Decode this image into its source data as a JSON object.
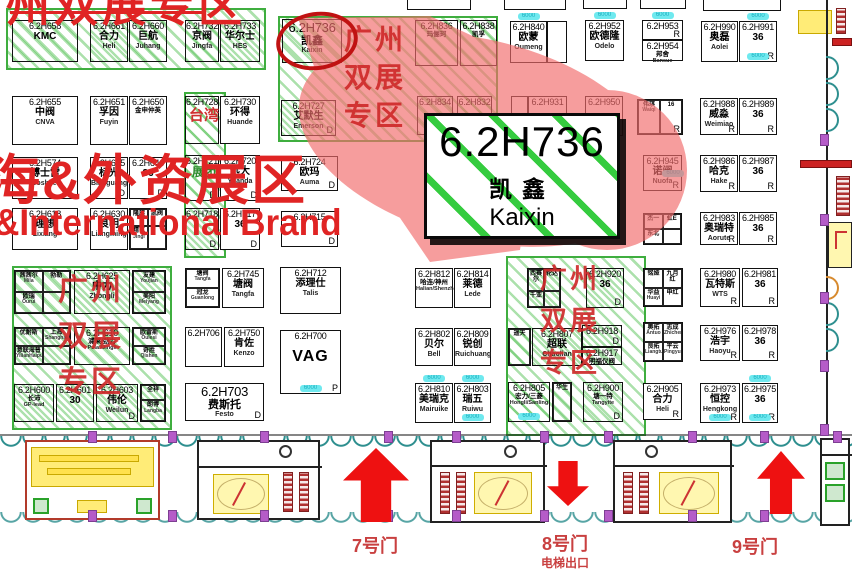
{
  "overlay": {
    "top_zone": "州双展专区",
    "brand_line1": "海&外资展区",
    "brand_line2": "&International Brand"
  },
  "highlight": {
    "code": "6.2H736",
    "cn": "凯鑫",
    "en": "Kaixin"
  },
  "badge_text": "6000",
  "colors": {
    "zone_green": "#3fae3f",
    "overlay_red": "#e02424",
    "blob_pink": "#f26c6c",
    "ellipse_red": "#c01212",
    "badge_cyan": "#6fe9ef",
    "arrow_red": "#ee1111",
    "gate_red": "#c94040",
    "column_purple": "#b55cc8",
    "wall_teal": "#2e8f8f"
  },
  "zones": [
    {
      "name": "zone-hatch-top-left",
      "x": 6,
      "y": 8,
      "w": 256,
      "h": 58
    },
    {
      "name": "zone-taiwan-strip",
      "x": 184,
      "y": 92,
      "w": 38,
      "h": 162
    },
    {
      "name": "zone-guangzhou-top-mid",
      "x": 278,
      "y": 16,
      "w": 216,
      "h": 122,
      "label": [
        "广州",
        "双展",
        "专区"
      ],
      "lx": 344,
      "ly": 26,
      "fs": 28,
      "gap": 10
    },
    {
      "name": "zone-guangzhou-left",
      "x": 12,
      "y": 266,
      "w": 156,
      "h": 160,
      "label": [
        "广州",
        "双展",
        "专区"
      ],
      "lx": 58,
      "ly": 276,
      "fs": 30,
      "gap": 16
    },
    {
      "name": "zone-guangzhou-right",
      "x": 506,
      "y": 256,
      "w": 136,
      "h": 176,
      "label": [
        "广州",
        "双展",
        "专区"
      ],
      "lx": 540,
      "ly": 266,
      "fs": 27,
      "gap": 15
    }
  ],
  "labels": [
    {
      "text": "台湾",
      "x": 189,
      "y": 108,
      "fs": 15,
      "color": "#d03030"
    },
    {
      "text": "展团",
      "x": 192,
      "y": 166,
      "fs": 12,
      "color": "#2a8a2a"
    }
  ],
  "slivers": [
    {
      "x": 407,
      "y": 0,
      "w": 62,
      "h": 9
    },
    {
      "x": 504,
      "y": 0,
      "w": 60,
      "h": 9
    },
    {
      "x": 583,
      "y": 0,
      "w": 42,
      "h": 8
    },
    {
      "x": 640,
      "y": 0,
      "w": 44,
      "h": 8
    },
    {
      "x": 703,
      "y": 0,
      "w": 76,
      "h": 10
    }
  ],
  "booths": [
    {
      "code": "6.2H658",
      "cn": "KMC",
      "x": 12,
      "y": 20,
      "w": 66,
      "h": 42,
      "hatch": 1
    },
    {
      "code": "6.2H661",
      "cn": "合力",
      "en": "Heli",
      "x": 90,
      "y": 20,
      "w": 38,
      "h": 42,
      "hatch": 1
    },
    {
      "code": "6.2H660",
      "cn": "巨航",
      "en": "Juhang",
      "x": 129,
      "y": 20,
      "w": 38,
      "h": 42,
      "hatch": 1
    },
    {
      "code": "6.2H732",
      "cn": "京阀",
      "en": "Jingfa",
      "x": 185,
      "y": 20,
      "w": 34,
      "h": 42,
      "hatch": 1
    },
    {
      "code": "6.2H733",
      "cn": "华尔士",
      "en": "HES",
      "x": 220,
      "y": 20,
      "w": 40,
      "h": 42,
      "hatch": 1
    },
    {
      "code": "6.2H736",
      "cn": "凯鑫",
      "en": "Kaixin",
      "x": 282,
      "y": 19,
      "w": 60,
      "h": 44,
      "hatch": 1,
      "big": 1
    },
    {
      "code": "6.2H836",
      "cn": "玛俪珂",
      "x": 415,
      "y": 20,
      "w": 43,
      "h": 46,
      "hatch": 1,
      "tiny": 1
    },
    {
      "code": "6.2H838",
      "cn": "凯孚",
      "x": 460,
      "y": 20,
      "w": 37,
      "h": 46,
      "hatch": 1,
      "tiny": 1
    },
    {
      "code": "6.2H840",
      "cn": "欧蒙",
      "en": "Oumeng",
      "x": 510,
      "y": 21,
      "w": 37,
      "h": 42,
      "badges": [
        "t"
      ]
    },
    {
      "code": "",
      "x": 547,
      "y": 21,
      "w": 20,
      "h": 42
    },
    {
      "code": "6.2H952",
      "cn": "欧德隆",
      "en": "Odelo",
      "x": 585,
      "y": 20,
      "w": 39,
      "h": 41,
      "badges": [
        "t"
      ]
    },
    {
      "code": "6.2H953",
      "marker": "R",
      "x": 642,
      "y": 20,
      "w": 41,
      "h": 20,
      "badges": [
        "t"
      ]
    },
    {
      "code": "6.2H954",
      "cn": "邦舍",
      "en": "Bansue",
      "x": 642,
      "y": 40,
      "w": 41,
      "h": 21,
      "tiny": 1
    },
    {
      "code": "6.2H990",
      "cn": "奥磊",
      "en": "Aolei",
      "x": 701,
      "y": 21,
      "w": 37,
      "h": 41
    },
    {
      "code": "6.2H991",
      "cn": "36",
      "marker": "R",
      "x": 739,
      "y": 21,
      "w": 38,
      "h": 41,
      "badges": [
        "t",
        "b"
      ]
    },
    {
      "code": "6.2H655",
      "cn": "中阀",
      "en": "CNVA",
      "x": 12,
      "y": 96,
      "w": 66,
      "h": 49
    },
    {
      "code": "6.2H651",
      "cn": "孚因",
      "en": "Fuyin",
      "x": 90,
      "y": 96,
      "w": 38,
      "h": 49
    },
    {
      "code": "6.2H650",
      "cn": "金申仲英",
      "x": 129,
      "y": 96,
      "w": 38,
      "h": 49,
      "tiny": 1
    },
    {
      "code": "6.2H728",
      "x": 185,
      "y": 96,
      "w": 34,
      "h": 48,
      "hatch": 1
    },
    {
      "code": "6.2H730",
      "cn": "环得",
      "en": "Huande",
      "x": 220,
      "y": 96,
      "w": 40,
      "h": 48
    },
    {
      "code": "6.2H727",
      "cn": "艾默生",
      "en": "Emerson",
      "x": 281,
      "y": 100,
      "w": 55,
      "h": 36,
      "hatch": 1,
      "marker": "D"
    },
    {
      "code": "6.2H834",
      "x": 417,
      "y": 96,
      "w": 36,
      "h": 39,
      "hatch": 1
    },
    {
      "code": "6.2H832",
      "x": 457,
      "y": 96,
      "w": 35,
      "h": 39,
      "hatch": 1
    },
    {
      "code": "",
      "x": 511,
      "y": 96,
      "w": 17,
      "h": 40
    },
    {
      "code": "6.2H931",
      "x": 528,
      "y": 96,
      "w": 39,
      "h": 40
    },
    {
      "code": "6.2H950",
      "x": 585,
      "y": 96,
      "w": 38,
      "h": 40
    },
    {
      "cells": [
        {
          "t": "伟琪",
          "e": "Waiqi"
        },
        {
          "t": "16"
        }
      ],
      "x": 637,
      "y": 99,
      "w": 46,
      "h": 36,
      "marker": "R"
    },
    {
      "code": "6.2H988",
      "cn": "威淼",
      "en": "Weimiao",
      "marker": "R",
      "x": 700,
      "y": 98,
      "w": 38,
      "h": 37
    },
    {
      "code": "6.2H989",
      "cn": "36",
      "marker": "R",
      "x": 739,
      "y": 98,
      "w": 38,
      "h": 37
    },
    {
      "code": "6.2H574",
      "cn": "博士雷",
      "en": "Boshilei",
      "x": 12,
      "y": 157,
      "w": 66,
      "h": 42
    },
    {
      "code": "6.2H645",
      "cn": "标光",
      "en": "Biaoguang",
      "marker": "D",
      "x": 90,
      "y": 157,
      "w": 38,
      "h": 42
    },
    {
      "code": "6.2H646",
      "cn": "36",
      "marker": "D",
      "x": 129,
      "y": 157,
      "w": 38,
      "h": 42
    },
    {
      "code": "6.2H721",
      "marker": "D",
      "x": 185,
      "y": 155,
      "w": 34,
      "h": 46,
      "hatch": 1
    },
    {
      "code": "6.2H720",
      "cn": "远大",
      "en": "Yuanda",
      "marker": "D",
      "x": 220,
      "y": 155,
      "w": 40,
      "h": 46
    },
    {
      "code": "6.2H724",
      "cn": "欧玛",
      "en": "Auma",
      "marker": "D",
      "x": 281,
      "y": 156,
      "w": 57,
      "h": 35
    },
    {
      "code": "6.2H945",
      "cn": "诺阀",
      "en": "Nuofa",
      "marker": "R",
      "x": 643,
      "y": 155,
      "w": 39,
      "h": 36,
      "badges": [
        "r"
      ]
    },
    {
      "code": "6.2H986",
      "cn": "哈克",
      "en": "Hake",
      "marker": "R",
      "x": 700,
      "y": 155,
      "w": 38,
      "h": 37
    },
    {
      "code": "6.2H987",
      "cn": "36",
      "marker": "R",
      "x": 739,
      "y": 155,
      "w": 38,
      "h": 37
    },
    {
      "code": "6.2H618",
      "cn": "理想",
      "en": "Lixiang",
      "x": 12,
      "y": 208,
      "w": 66,
      "h": 42
    },
    {
      "code": "6.2H630",
      "cn": "良明",
      "en": "Liangming",
      "x": 90,
      "y": 208,
      "w": 38,
      "h": 42
    },
    {
      "cells": [
        {
          "t": "隆旗"
        },
        {
          "t": "凯阀"
        },
        {
          "t": "精艺",
          "e": "Jingi"
        },
        {
          "t": ""
        }
      ],
      "x": 129,
      "y": 208,
      "w": 38,
      "h": 42
    },
    {
      "code": "6.2H718",
      "marker": "D",
      "x": 185,
      "y": 208,
      "w": 34,
      "h": 42,
      "hatch": 1
    },
    {
      "code": "6.2H717",
      "cn": "36",
      "marker": "D",
      "x": 220,
      "y": 208,
      "w": 40,
      "h": 42
    },
    {
      "code": "6.2H715",
      "marker": "D",
      "x": 281,
      "y": 211,
      "w": 57,
      "h": 36
    },
    {
      "cells": [
        {
          "t": "杰一"
        },
        {
          "t": "虹E"
        },
        {
          "t": "东北"
        },
        {
          "t": ""
        }
      ],
      "x": 643,
      "y": 213,
      "w": 39,
      "h": 32
    },
    {
      "code": "6.2H983",
      "cn": "奥瑞特",
      "en": "Aorute",
      "marker": "R",
      "x": 700,
      "y": 212,
      "w": 38,
      "h": 33
    },
    {
      "code": "6.2H985",
      "cn": "36",
      "marker": "R",
      "x": 739,
      "y": 212,
      "w": 38,
      "h": 33
    },
    {
      "cells": [
        {
          "t": "茜茜尔",
          "e": "Mila"
        },
        {
          "t": "勃勒"
        },
        {
          "t": "欧瑞",
          "e": "Ourui"
        },
        {
          "t": ""
        }
      ],
      "x": 14,
      "y": 270,
      "w": 57,
      "h": 44,
      "hatch": 1
    },
    {
      "code": "6.2H625",
      "cn": "中力",
      "en": "Zhongli",
      "x": 74,
      "y": 270,
      "w": 56,
      "h": 44,
      "hatch": 1
    },
    {
      "cells": [
        {
          "t": "友建",
          "e": "Youjian"
        },
        {
          "t": "美阳",
          "e": "Meiyang"
        }
      ],
      "cols": 1,
      "x": 132,
      "y": 270,
      "w": 34,
      "h": 44,
      "hatch": 1
    },
    {
      "cells": [
        {
          "t": "优耐斯"
        },
        {
          "t": "上海",
          "e": "Shanghai"
        },
        {
          "t": "意联海普",
          "e": "YilianHaipu"
        },
        {
          "t": ""
        }
      ],
      "x": 14,
      "y": 327,
      "w": 57,
      "h": 38,
      "hatch": 1
    },
    {
      "code": "6.2H610",
      "cn": "浦莱/劲力",
      "en": "Pulai/Jingli",
      "x": 74,
      "y": 327,
      "w": 56,
      "h": 38,
      "hatch": 1,
      "tiny": 1
    },
    {
      "cells": [
        {
          "t": "欧雷斯",
          "e": "Oulesi"
        },
        {
          "t": "奇胜",
          "e": "Qishen"
        }
      ],
      "cols": 1,
      "x": 132,
      "y": 327,
      "w": 34,
      "h": 38,
      "hatch": 1
    },
    {
      "code": "6.2H600",
      "cn": "长沛",
      "en": "GP-lead",
      "x": 14,
      "y": 384,
      "w": 40,
      "h": 38,
      "hatch": 1,
      "tiny": 1
    },
    {
      "code": "6.2H601",
      "cn": "30",
      "x": 56,
      "y": 384,
      "w": 38,
      "h": 38,
      "hatch": 1
    },
    {
      "code": "6.2H603",
      "cn": "伟伦",
      "en": "Weilun",
      "marker": "D",
      "x": 96,
      "y": 384,
      "w": 42,
      "h": 38,
      "hatch": 1
    },
    {
      "cells": [
        {
          "t": "全祥"
        },
        {
          "t": "朗博",
          "e": "Langba"
        }
      ],
      "cols": 1,
      "x": 140,
      "y": 384,
      "w": 26,
      "h": 38,
      "hatch": 1
    },
    {
      "cells": [
        {
          "t": "塘阀",
          "e": "Tangfa"
        },
        {
          "t": "冠龙",
          "e": "Guanlong"
        }
      ],
      "cols": 1,
      "x": 185,
      "y": 268,
      "w": 35,
      "h": 40
    },
    {
      "code": "6.2H745",
      "cn": "塘阀",
      "en": "Tangfa",
      "x": 222,
      "y": 268,
      "w": 42,
      "h": 40
    },
    {
      "code": "6.2H706",
      "x": 185,
      "y": 327,
      "w": 37,
      "h": 40
    },
    {
      "code": "6.2H750",
      "cn": "肯佐",
      "en": "Kenzo",
      "x": 224,
      "y": 327,
      "w": 40,
      "h": 40
    },
    {
      "code": "6.2H703",
      "cn": "费斯托",
      "en": "Festo",
      "marker": "D",
      "x": 185,
      "y": 383,
      "w": 79,
      "h": 38,
      "big": 1
    },
    {
      "code": "6.2H712",
      "cn": "添理仕",
      "en": "Talis",
      "x": 280,
      "y": 267,
      "w": 61,
      "h": 47
    },
    {
      "code": "6.2H700",
      "cn": "VAG",
      "marker": "P",
      "x": 280,
      "y": 330,
      "w": 61,
      "h": 64,
      "vag": 1,
      "badges": [
        "b"
      ]
    },
    {
      "code": "6.2H812",
      "cn": "哈连/神州",
      "en": "Halian/Shenzhou",
      "x": 415,
      "y": 268,
      "w": 38,
      "h": 40,
      "tiny": 1
    },
    {
      "code": "6.2H814",
      "cn": "莱德",
      "en": "Lede",
      "x": 454,
      "y": 268,
      "w": 37,
      "h": 40
    },
    {
      "code": "6.2H802",
      "cn": "贝尔",
      "en": "Bell",
      "x": 415,
      "y": 328,
      "w": 38,
      "h": 38
    },
    {
      "code": "6.2H809",
      "cn": "锐创",
      "en": "Ruichuang",
      "x": 454,
      "y": 328,
      "w": 37,
      "h": 38
    },
    {
      "code": "6.2H810",
      "cn": "美瑞克",
      "en": "Mairuike",
      "x": 415,
      "y": 383,
      "w": 38,
      "h": 40,
      "badges": [
        "t"
      ]
    },
    {
      "code": "6.2H803",
      "cn": "瑞五",
      "en": "Ruiwu",
      "x": 454,
      "y": 383,
      "w": 37,
      "h": 40,
      "badges": [
        "t",
        "b"
      ]
    },
    {
      "cells": [
        {
          "t": "西赛尔"
        },
        {
          "t": "轮达"
        },
        {
          "t": "千亚"
        },
        {
          "t": ""
        }
      ],
      "x": 527,
      "y": 268,
      "w": 34,
      "h": 40,
      "hatch": 1
    },
    {
      "code": "6.2H920",
      "cn": "36",
      "marker": "D",
      "x": 586,
      "y": 268,
      "w": 38,
      "h": 40,
      "hatch": 1
    },
    {
      "cells": [
        {
          "t": "遥天"
        }
      ],
      "cols": 1,
      "x": 508,
      "y": 328,
      "w": 23,
      "h": 38,
      "hatch": 1
    },
    {
      "code": "6.2H807",
      "cn": "超联",
      "en": "Chaolian",
      "x": 532,
      "y": 328,
      "w": 50,
      "h": 38,
      "hatch": 1
    },
    {
      "code": "6.2H918",
      "marker": "D",
      "x": 582,
      "y": 325,
      "w": 40,
      "h": 22,
      "hatch": 1
    },
    {
      "code": "6.2H917",
      "cn": "明福仪阀",
      "x": 582,
      "y": 347,
      "w": 40,
      "h": 18,
      "hatch": 1,
      "tiny": 1
    },
    {
      "code": "6.2H805",
      "cn": "宏力/三菱",
      "en": "Hongli/Sanling",
      "x": 508,
      "y": 382,
      "w": 42,
      "h": 40,
      "hatch": 1,
      "tiny": 1,
      "badges": [
        "b"
      ]
    },
    {
      "cells": [
        {
          "t": "华生"
        }
      ],
      "cols": 1,
      "x": 552,
      "y": 382,
      "w": 20,
      "h": 40,
      "hatch": 1
    },
    {
      "code": "6.2H900",
      "cn": "塘一特",
      "en": "Tangyite",
      "marker": "D",
      "x": 583,
      "y": 382,
      "w": 40,
      "h": 40,
      "hatch": 1,
      "tiny": 1
    },
    {
      "cells": [
        {
          "t": "铭娅"
        },
        {
          "t": "九月红"
        },
        {
          "t": "华益",
          "e": "Huayi"
        },
        {
          "t": "申红"
        }
      ],
      "x": 643,
      "y": 268,
      "w": 40,
      "h": 39
    },
    {
      "code": "6.2H980",
      "cn": "瓦特斯",
      "en": "WTS",
      "marker": "R",
      "x": 700,
      "y": 268,
      "w": 40,
      "h": 39
    },
    {
      "code": "6.2H981",
      "cn": "36",
      "marker": "R",
      "x": 742,
      "y": 268,
      "w": 36,
      "h": 39
    },
    {
      "cells": [
        {
          "t": "奥拓",
          "e": "Antuo"
        },
        {
          "t": "志成",
          "e": "Zhicheng"
        },
        {
          "t": "良拓",
          "e": "Liangtuo"
        },
        {
          "t": "平云",
          "e": "Pingyun"
        }
      ],
      "x": 643,
      "y": 322,
      "w": 40,
      "h": 40
    },
    {
      "code": "6.2H976",
      "cn": "浩宇",
      "en": "Haoyu",
      "marker": "R",
      "x": 700,
      "y": 325,
      "w": 40,
      "h": 36
    },
    {
      "code": "6.2H978",
      "cn": "36",
      "marker": "R",
      "x": 742,
      "y": 325,
      "w": 36,
      "h": 36
    },
    {
      "code": "6.2H905",
      "cn": "合力",
      "en": "Heli",
      "marker": "R",
      "x": 643,
      "y": 383,
      "w": 39,
      "h": 37
    },
    {
      "code": "6.2H973",
      "cn": "恒控",
      "en": "Hengkong",
      "marker": "R",
      "x": 700,
      "y": 383,
      "w": 40,
      "h": 40,
      "badges": [
        "b"
      ]
    },
    {
      "code": "6.2H975",
      "cn": "36",
      "marker": "R",
      "x": 742,
      "y": 383,
      "w": 36,
      "h": 40,
      "badges": [
        "t",
        "b"
      ]
    }
  ],
  "gates": [
    {
      "label": "7号门",
      "sub": "",
      "x": 330,
      "y": 536,
      "w": 90
    },
    {
      "label": "8号门",
      "sub": "电梯出口",
      "x": 505,
      "y": 534,
      "w": 120
    },
    {
      "label": "9号门",
      "sub": "",
      "x": 710,
      "y": 537,
      "w": 90
    }
  ],
  "arrows": [
    {
      "dir": "up",
      "x": 343,
      "y": 448,
      "w": 66,
      "h": 74
    },
    {
      "dir": "down",
      "x": 547,
      "y": 461,
      "w": 42,
      "h": 45
    },
    {
      "dir": "up",
      "x": 757,
      "y": 451,
      "w": 48,
      "h": 63
    }
  ]
}
